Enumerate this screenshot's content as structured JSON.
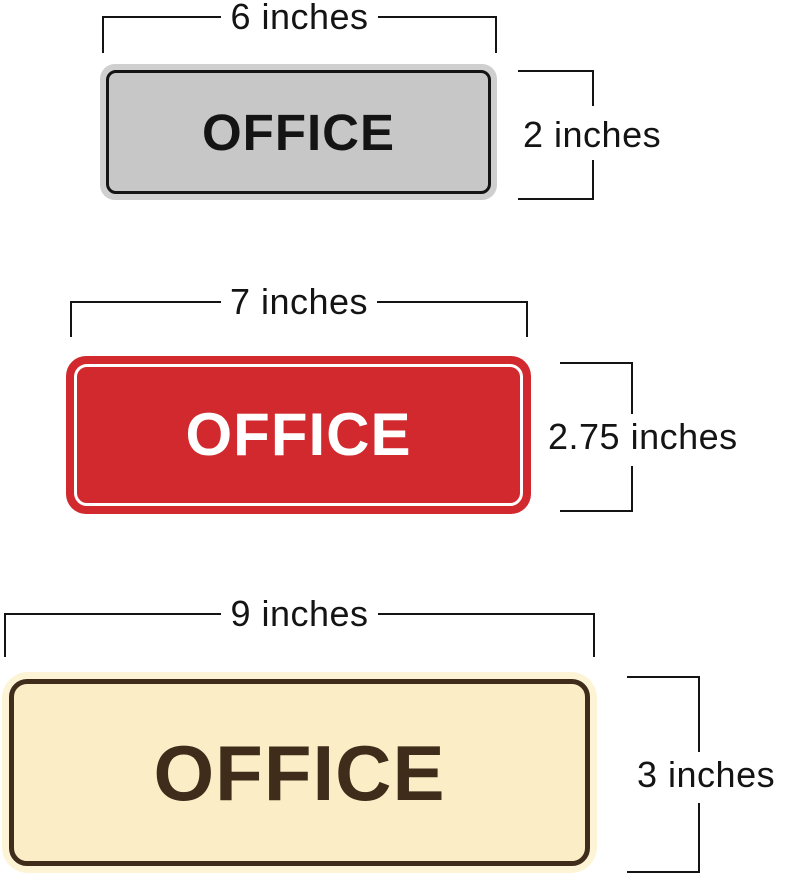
{
  "diagram": {
    "title": "Office sign size comparison",
    "dimension_color": "#141414",
    "signs": [
      {
        "size_name": "small",
        "text": "OFFICE",
        "width_label": "6 inches",
        "height_label": "2 inches",
        "rim": "#cfcfcf",
        "fill": "#c6c7c6",
        "border": "#141414",
        "text_color": "#141414"
      },
      {
        "size_name": "medium",
        "text": "OFFICE",
        "width_label": "7 inches",
        "height_label": "2.75 inches",
        "rim": "#d2292e",
        "fill": "#d2292e",
        "border": "#ffffff",
        "text_color": "#ffffff"
      },
      {
        "size_name": "large",
        "text": "OFFICE",
        "width_label": "9 inches",
        "height_label": "3 inches",
        "rim": "#fdf4d6",
        "fill": "#fbeec6",
        "border": "#3f2c1b",
        "text_color": "#3f2c1b"
      }
    ]
  }
}
